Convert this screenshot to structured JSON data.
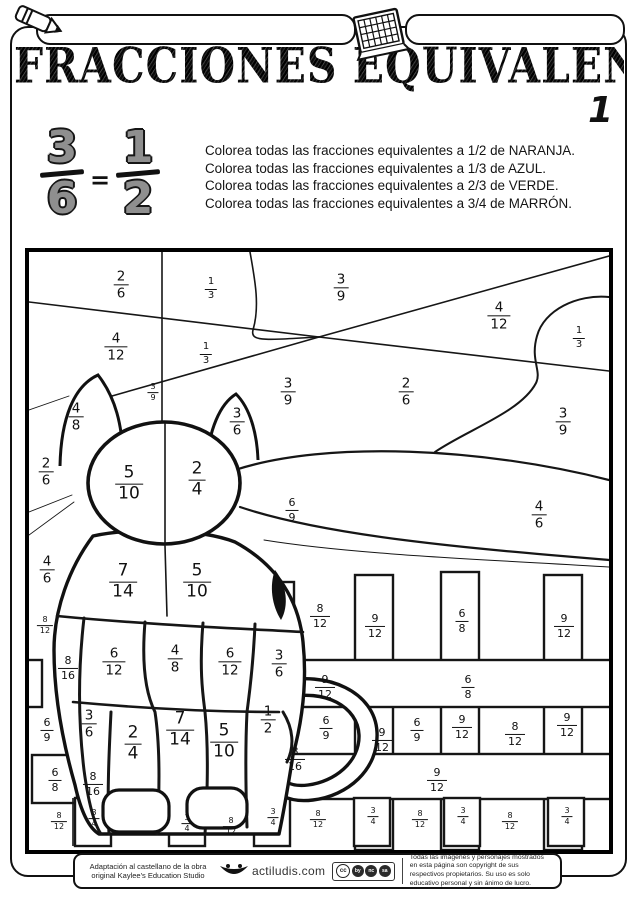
{
  "header": {
    "title": "FRACCIONES EQUIVALENTES",
    "page_number": "1",
    "name_field_value": "",
    "date_field_value": ""
  },
  "example": {
    "left": {
      "n": "3",
      "d": "6"
    },
    "equals": "=",
    "right": {
      "n": "1",
      "d": "2"
    }
  },
  "instructions": [
    "Colorea todas las fracciones equivalentes a 1/2 de NARANJA.",
    "Colorea todas las fracciones equivalentes a 1/3 de AZUL.",
    "Colorea todas las fracciones equivalentes a 2/3 de VERDE.",
    "Colorea todas las fracciones equivalentes a 3/4 de MARRÓN."
  ],
  "color_key": {
    "1/2": "NARANJA",
    "1/3": "AZUL",
    "2/3": "VERDE",
    "3/4": "MARRÓN"
  },
  "puzzle": {
    "fractions": [
      {
        "n": "2",
        "d": "6",
        "x": 92,
        "y": 33,
        "s": "lg"
      },
      {
        "n": "1",
        "d": "3",
        "x": 182,
        "y": 37,
        "s": "sm"
      },
      {
        "n": "3",
        "d": "9",
        "x": 312,
        "y": 36,
        "s": "lg"
      },
      {
        "n": "4",
        "d": "12",
        "x": 470,
        "y": 64,
        "s": "lg"
      },
      {
        "n": "1",
        "d": "3",
        "x": 550,
        "y": 86,
        "s": "sm"
      },
      {
        "n": "4",
        "d": "12",
        "x": 87,
        "y": 95,
        "s": "lg"
      },
      {
        "n": "1",
        "d": "3",
        "x": 177,
        "y": 102,
        "s": "sm"
      },
      {
        "n": "3",
        "d": "9",
        "x": 124,
        "y": 141,
        "s": "xs"
      },
      {
        "n": "3",
        "d": "9",
        "x": 259,
        "y": 140,
        "s": "lg"
      },
      {
        "n": "2",
        "d": "6",
        "x": 377,
        "y": 140,
        "s": "lg"
      },
      {
        "n": "3",
        "d": "9",
        "x": 534,
        "y": 170,
        "s": "lg"
      },
      {
        "n": "4",
        "d": "8",
        "x": 47,
        "y": 165,
        "s": "lg"
      },
      {
        "n": "3",
        "d": "6",
        "x": 208,
        "y": 170,
        "s": "lg"
      },
      {
        "n": "2",
        "d": "6",
        "x": 17,
        "y": 220,
        "s": "lg"
      },
      {
        "n": "5",
        "d": "10",
        "x": 100,
        "y": 232,
        "s": "xl"
      },
      {
        "n": "2",
        "d": "4",
        "x": 168,
        "y": 228,
        "s": "xl"
      },
      {
        "n": "6",
        "d": "9",
        "x": 263,
        "y": 258,
        "s": "md"
      },
      {
        "n": "4",
        "d": "6",
        "x": 510,
        "y": 263,
        "s": "lg"
      },
      {
        "n": "4",
        "d": "6",
        "x": 18,
        "y": 318,
        "s": "lg"
      },
      {
        "n": "8",
        "d": "12",
        "x": 16,
        "y": 374,
        "s": "xs"
      },
      {
        "n": "7",
        "d": "14",
        "x": 94,
        "y": 330,
        "s": "xl"
      },
      {
        "n": "5",
        "d": "10",
        "x": 168,
        "y": 330,
        "s": "xl"
      },
      {
        "n": "8",
        "d": "12",
        "x": 291,
        "y": 364,
        "s": "md"
      },
      {
        "n": "9",
        "d": "12",
        "x": 346,
        "y": 374,
        "s": "md"
      },
      {
        "n": "6",
        "d": "8",
        "x": 433,
        "y": 369,
        "s": "md"
      },
      {
        "n": "9",
        "d": "12",
        "x": 535,
        "y": 374,
        "s": "md"
      },
      {
        "n": "8",
        "d": "16",
        "x": 39,
        "y": 416,
        "s": "md"
      },
      {
        "n": "6",
        "d": "12",
        "x": 85,
        "y": 410,
        "s": "lg"
      },
      {
        "n": "4",
        "d": "8",
        "x": 146,
        "y": 407,
        "s": "lg"
      },
      {
        "n": "6",
        "d": "12",
        "x": 201,
        "y": 410,
        "s": "lg"
      },
      {
        "n": "3",
        "d": "6",
        "x": 250,
        "y": 412,
        "s": "lg"
      },
      {
        "n": "9",
        "d": "12",
        "x": 296,
        "y": 435,
        "s": "md"
      },
      {
        "n": "6",
        "d": "8",
        "x": 439,
        "y": 435,
        "s": "md"
      },
      {
        "n": "6",
        "d": "9",
        "x": 18,
        "y": 478,
        "s": "md"
      },
      {
        "n": "3",
        "d": "6",
        "x": 60,
        "y": 472,
        "s": "lg"
      },
      {
        "n": "2",
        "d": "4",
        "x": 104,
        "y": 492,
        "s": "xl"
      },
      {
        "n": "7",
        "d": "14",
        "x": 151,
        "y": 478,
        "s": "xl"
      },
      {
        "n": "5",
        "d": "10",
        "x": 195,
        "y": 490,
        "s": "xl"
      },
      {
        "n": "1",
        "d": "2",
        "x": 239,
        "y": 468,
        "s": "lg"
      },
      {
        "n": "8",
        "d": "16",
        "x": 266,
        "y": 507,
        "s": "md"
      },
      {
        "n": "6",
        "d": "9",
        "x": 297,
        "y": 476,
        "s": "md"
      },
      {
        "n": "9",
        "d": "12",
        "x": 353,
        "y": 488,
        "s": "md"
      },
      {
        "n": "6",
        "d": "9",
        "x": 388,
        "y": 478,
        "s": "md"
      },
      {
        "n": "9",
        "d": "12",
        "x": 433,
        "y": 475,
        "s": "md"
      },
      {
        "n": "8",
        "d": "12",
        "x": 486,
        "y": 482,
        "s": "md"
      },
      {
        "n": "9",
        "d": "12",
        "x": 538,
        "y": 473,
        "s": "md"
      },
      {
        "n": "6",
        "d": "8",
        "x": 26,
        "y": 528,
        "s": "md"
      },
      {
        "n": "8",
        "d": "16",
        "x": 64,
        "y": 532,
        "s": "md"
      },
      {
        "n": "9",
        "d": "12",
        "x": 408,
        "y": 528,
        "s": "md"
      },
      {
        "n": "8",
        "d": "12",
        "x": 30,
        "y": 570,
        "s": "xs"
      },
      {
        "n": "3",
        "d": "4",
        "x": 65,
        "y": 567,
        "s": "xs"
      },
      {
        "n": "3",
        "d": "4",
        "x": 158,
        "y": 572,
        "s": "xs"
      },
      {
        "n": "8",
        "d": "12",
        "x": 202,
        "y": 575,
        "s": "xs"
      },
      {
        "n": "3",
        "d": "4",
        "x": 244,
        "y": 566,
        "s": "xs"
      },
      {
        "n": "8",
        "d": "12",
        "x": 289,
        "y": 568,
        "s": "xs"
      },
      {
        "n": "3",
        "d": "4",
        "x": 344,
        "y": 565,
        "s": "xs"
      },
      {
        "n": "8",
        "d": "12",
        "x": 391,
        "y": 568,
        "s": "xs"
      },
      {
        "n": "3",
        "d": "4",
        "x": 434,
        "y": 565,
        "s": "xs"
      },
      {
        "n": "8",
        "d": "12",
        "x": 481,
        "y": 570,
        "s": "xs"
      },
      {
        "n": "3",
        "d": "4",
        "x": 538,
        "y": 565,
        "s": "xs"
      }
    ]
  },
  "footer": {
    "credit_line1": "Adaptación al castellano de la obra",
    "credit_line2": "original Kaylee's Education Studio",
    "site": "actiludis.com",
    "license": "cc",
    "license_marks": [
      "by",
      "nc",
      "sa"
    ],
    "rights_line1": "Todas las imágenes y personajes mostrados en esta página son copyright de sus",
    "rights_line2": "respectivos propietarios. Su uso es solo educativo personal y sin ánimo de lucro."
  }
}
